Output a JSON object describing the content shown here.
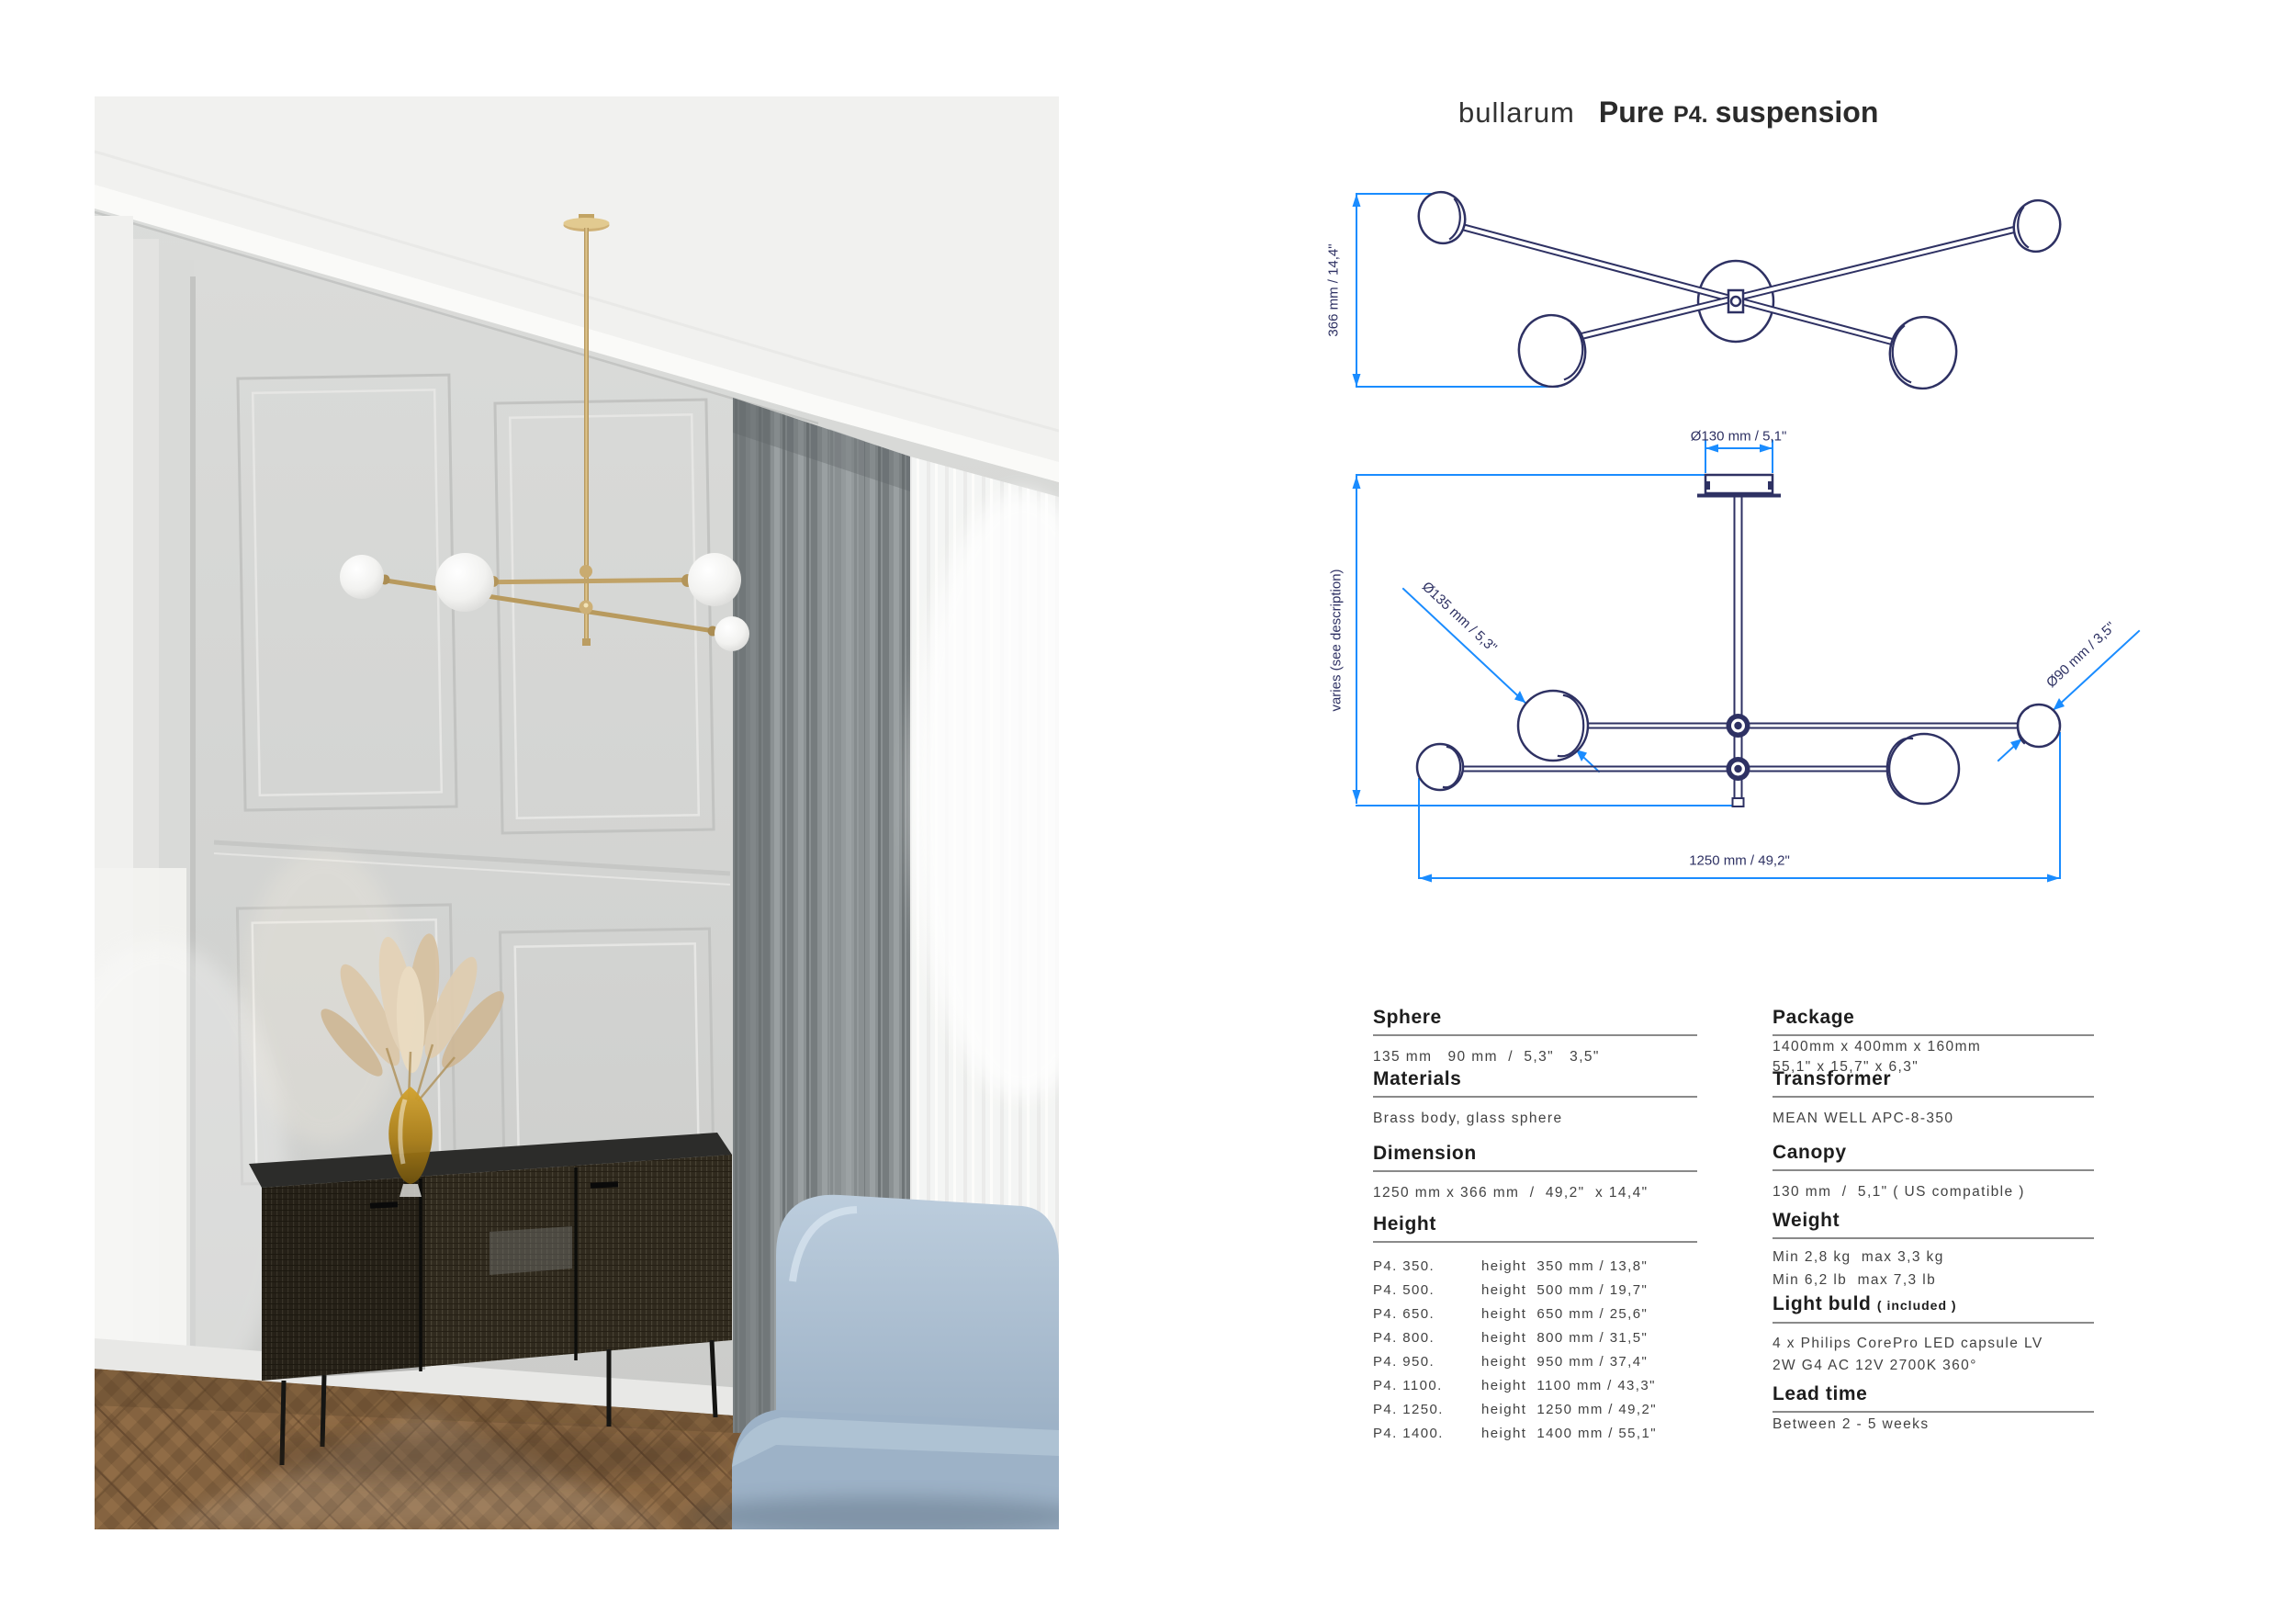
{
  "title": {
    "brand": "bullarum",
    "product": "Pure",
    "model": "P4.",
    "type": "suspension"
  },
  "drawings": {
    "top_view": {
      "dim_height": "366 mm  /  14,4\""
    },
    "side_view": {
      "dim_canopy": "Ø130 mm  /  5,1\"",
      "dim_drop": "varies (see description)",
      "dim_sphere_large": "Ø135 mm  /  5,3\"",
      "dim_sphere_small": "Ø90 mm  /  3,5\"",
      "dim_width": "1250 mm  /  49,2\""
    }
  },
  "specs": {
    "left": {
      "sphere": {
        "heading": "Sphere",
        "value": "135 mm   90 mm  /  5,3\"   3,5\""
      },
      "materials": {
        "heading": "Materials",
        "value": "Brass body, glass sphere"
      },
      "dimension": {
        "heading": "Dimension",
        "value": "1250 mm x 366 mm  /  49,2\"  x 14,4\""
      },
      "height": {
        "heading": "Height",
        "rows": [
          {
            "model": "P4. 350.",
            "value": "height  350 mm / 13,8\""
          },
          {
            "model": "P4. 500.",
            "value": "height  500 mm / 19,7\""
          },
          {
            "model": "P4. 650.",
            "value": "height  650 mm / 25,6\""
          },
          {
            "model": "P4. 800.",
            "value": "height  800 mm / 31,5\""
          },
          {
            "model": "P4. 950.",
            "value": "height  950 mm / 37,4\""
          },
          {
            "model": "P4. 1100.",
            "value": "height  1100 mm / 43,3\""
          },
          {
            "model": "P4. 1250.",
            "value": "height  1250 mm / 49,2\""
          },
          {
            "model": "P4. 1400.",
            "value": "height  1400 mm / 55,1\""
          }
        ]
      }
    },
    "right": {
      "package": {
        "heading": "Package",
        "line1": "1400mm x 400mm x 160mm",
        "line2": "55,1\" x 15,7\" x 6,3\""
      },
      "transformer": {
        "heading": "Transformer",
        "value": "MEAN WELL APC-8-350"
      },
      "canopy": {
        "heading": "Canopy",
        "value": "130 mm  /  5,1\" ( US compatible )"
      },
      "weight": {
        "heading": "Weight",
        "line1": "Min 2,8 kg  max 3,3 kg",
        "line2": "Min 6,2 lb  max 7,3 lb"
      },
      "bulb": {
        "heading": "Light buld",
        "heading_note": "( included )",
        "line1": "4 x Philips CorePro LED capsule LV",
        "line2": "2W G4 AC 12V 2700K 360°"
      },
      "lead": {
        "heading": "Lead time",
        "value": "Between 2 - 5 weeks"
      }
    }
  },
  "colors": {
    "dimension_blue": "#1a8cff",
    "drawing_navy": "#2e3163",
    "brass": "#c5a566",
    "text_dark": "#2b2b2b",
    "text_body": "#424242"
  }
}
